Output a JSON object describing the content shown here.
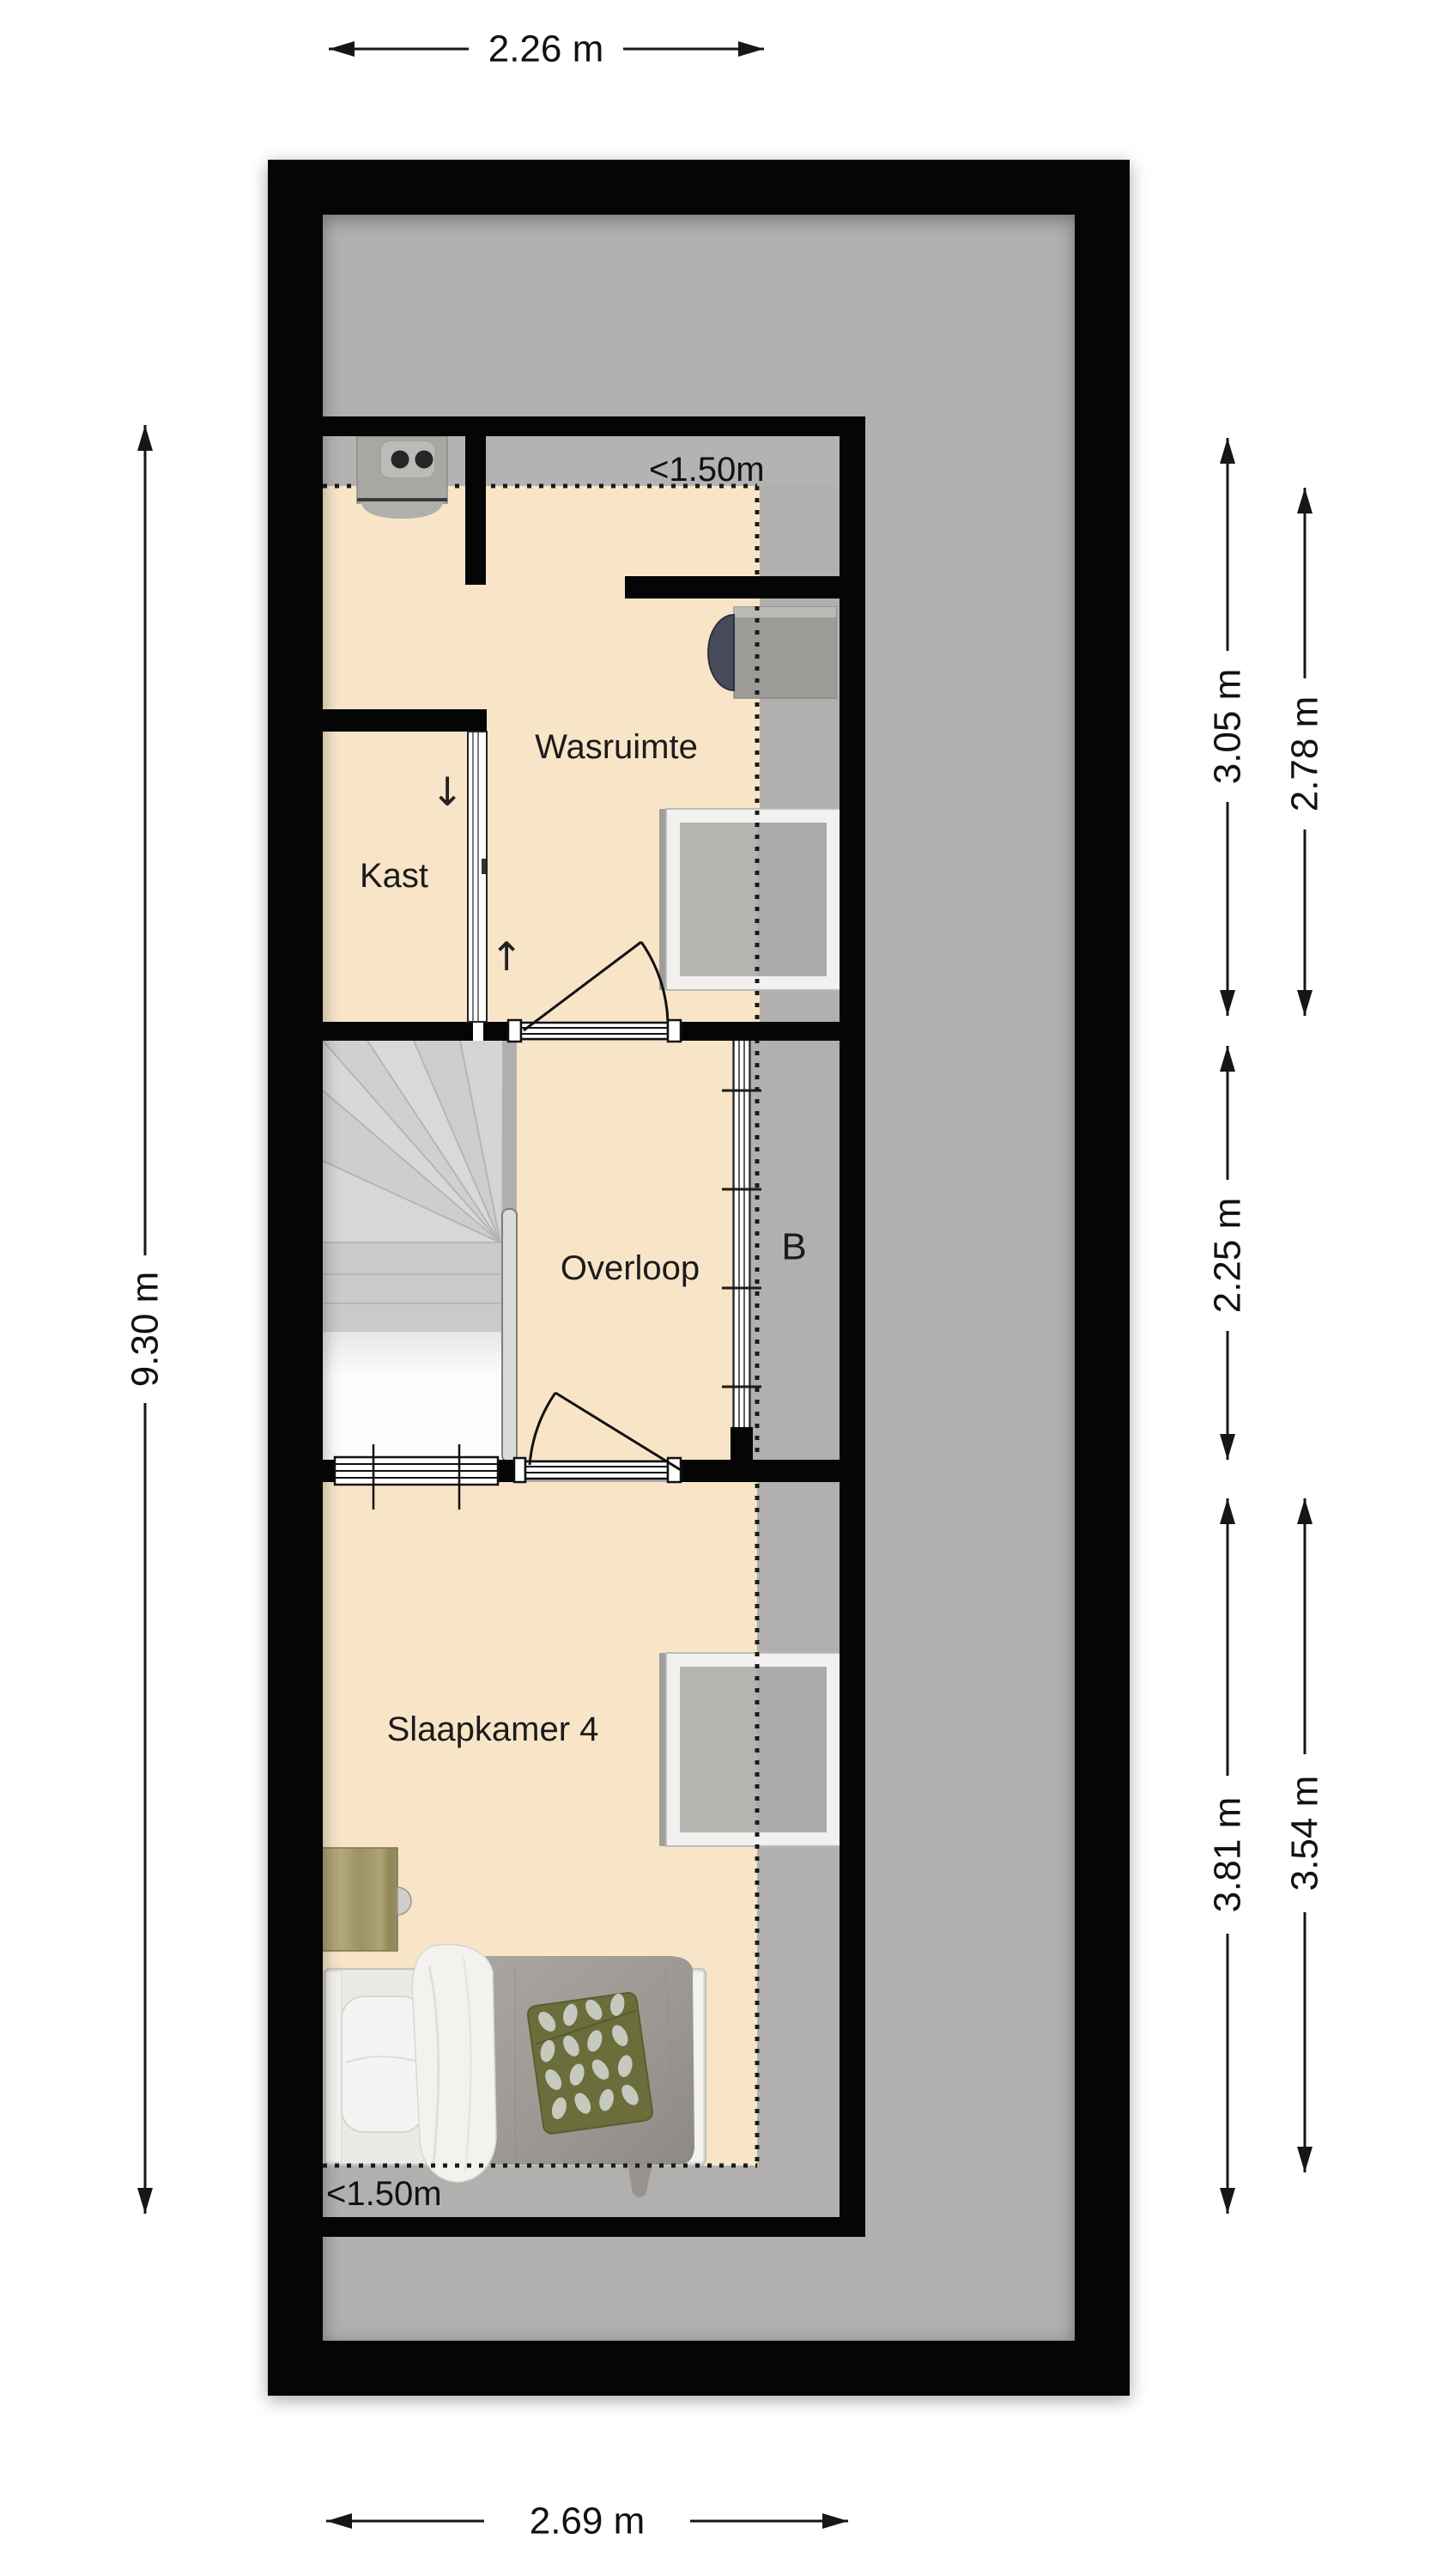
{
  "rooms": {
    "wasruimte": "Wasruimte",
    "kast": "Kast",
    "overloop": "Overloop",
    "b": "B",
    "slaapkamer": "Slaapkamer 4"
  },
  "headroom": {
    "top": "<1.50m",
    "bottom": "<1.50m"
  },
  "dimensions": {
    "top": "2.26 m",
    "bottom": "2.69 m",
    "left": "9.30 m",
    "right_top_inner": "3.05 m",
    "right_top_outer": "2.78 m",
    "right_middle": "2.25 m",
    "right_bottom_inner": "3.81 m",
    "right_bottom_outer": "3.54 m"
  },
  "stairs": {
    "arrow_down": "↓",
    "arrow_up": "↑"
  },
  "colors": {
    "wall": "#050505",
    "floor_attic_gray": "#b2b0ae",
    "floor_room_beige": "#f8e5c8",
    "stair_gray": "#cfcecc",
    "desk_wood": "#a89e6f",
    "blanket_gray": "#9e9b97",
    "leaf_pillow_olive": "#6b6e3a"
  }
}
